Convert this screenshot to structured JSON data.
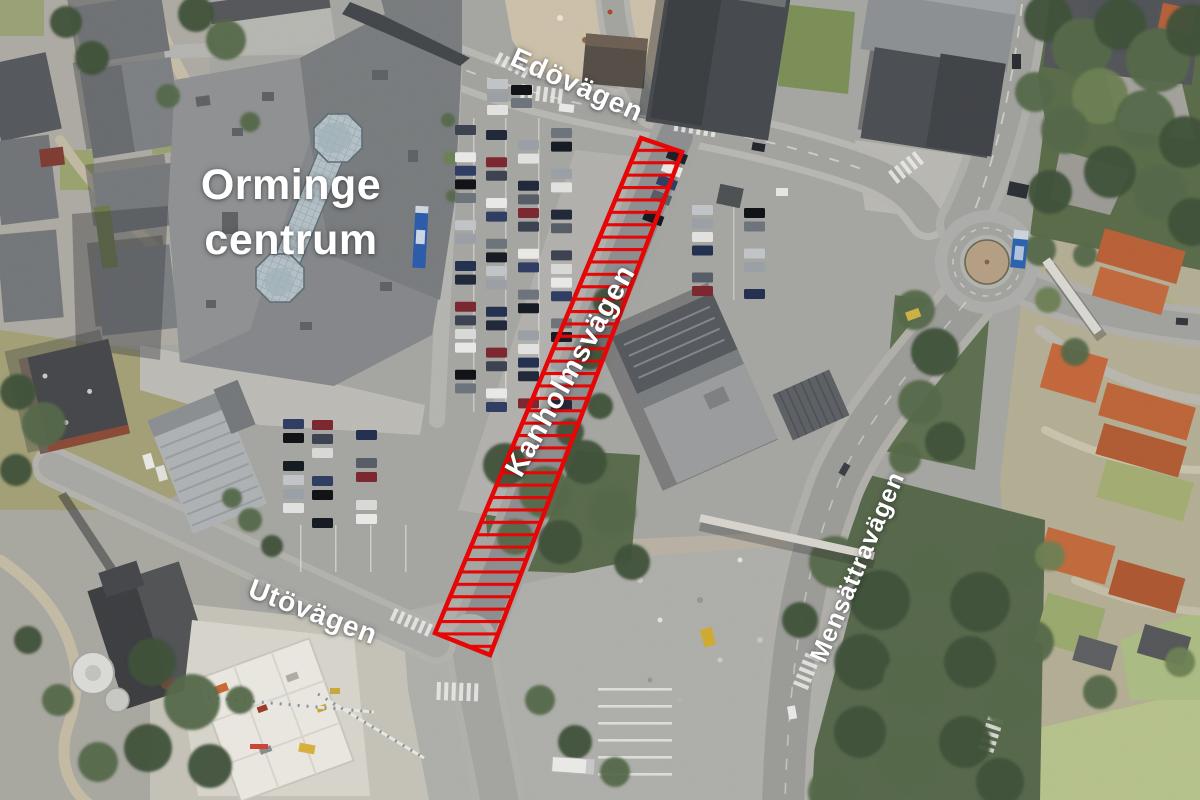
{
  "image": {
    "kind": "aerial-orthophoto",
    "width_px": 1200,
    "height_px": 800
  },
  "labels": {
    "place": {
      "line1": "Orminge",
      "line2": "centrum"
    },
    "roads": [
      {
        "id": "edovagen",
        "text": "Edövägen"
      },
      {
        "id": "kanholmsvagen",
        "text": "Kanholmsvägen"
      },
      {
        "id": "utovagen",
        "text": "Utövägen"
      },
      {
        "id": "mensattravagen",
        "text": "Mensättravägen"
      }
    ],
    "color": "#ffffff"
  },
  "highlight": {
    "kind": "hatched-zone",
    "road": "Kanholmsvägen",
    "points": "641,138 682,152 490,655 435,633",
    "color": "#e60606"
  }
}
